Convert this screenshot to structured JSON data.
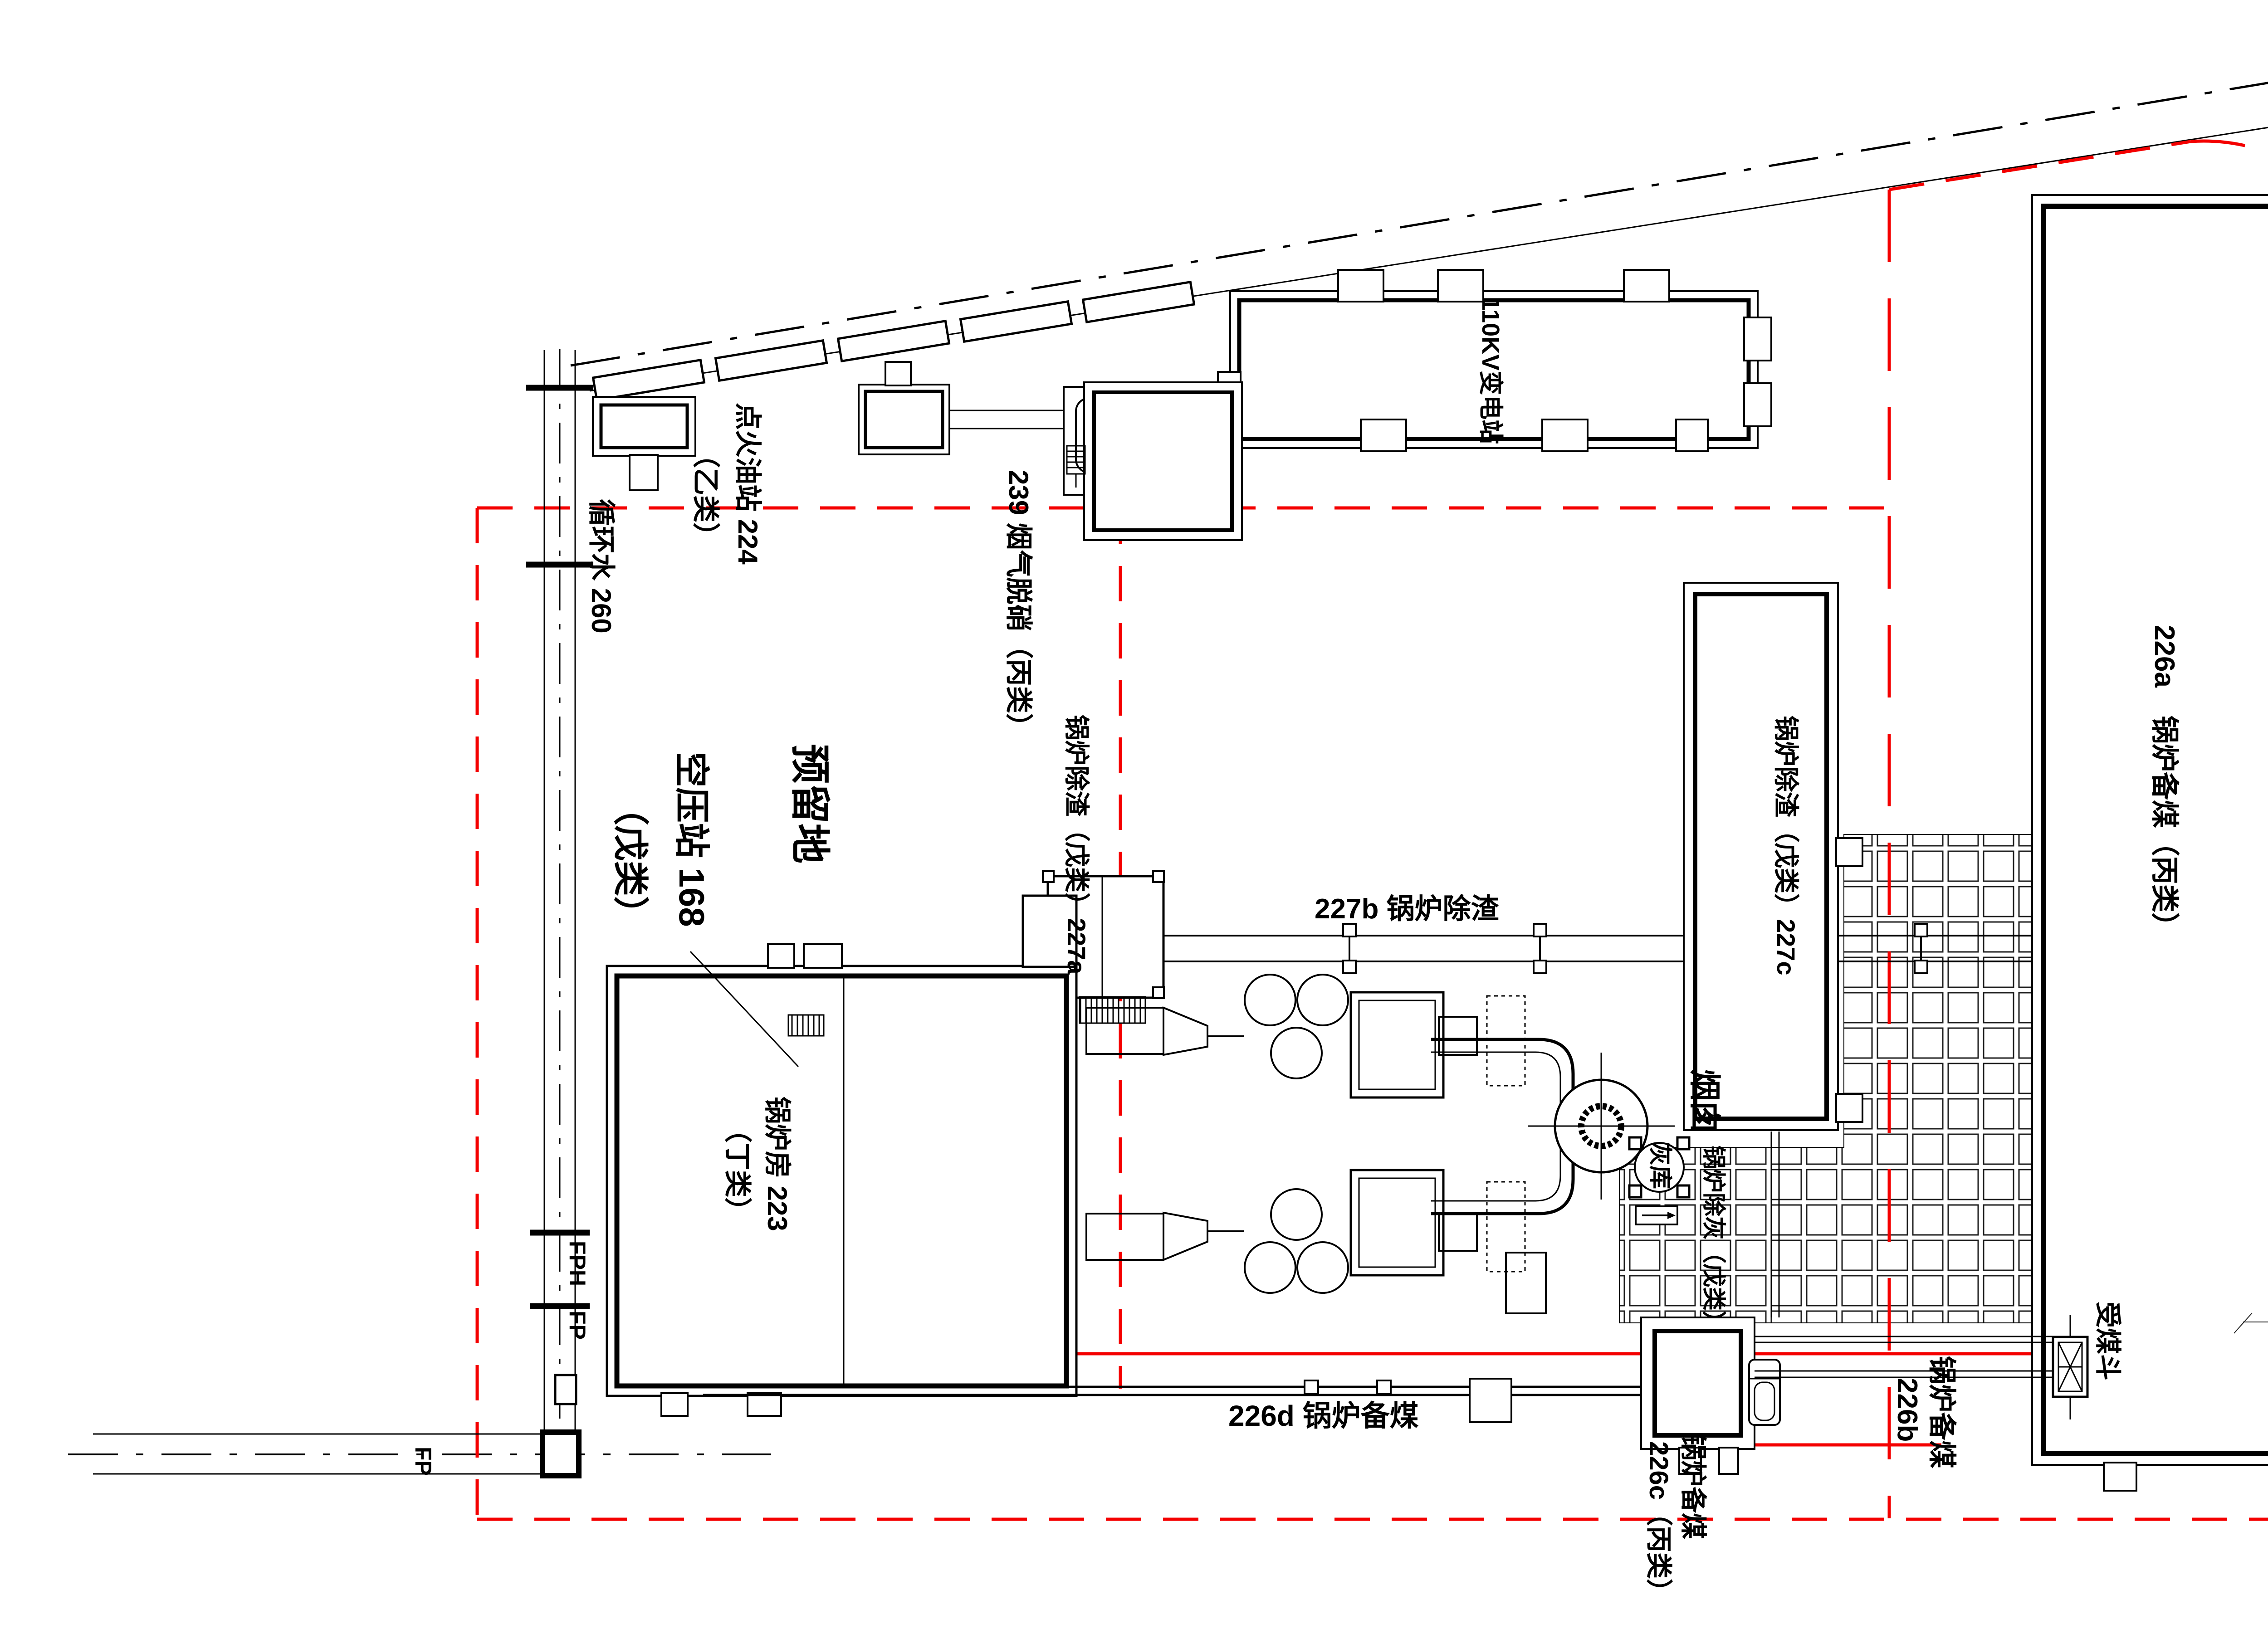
{
  "labels": {
    "substation": "110KV变电站",
    "coal_226a": "226a　锅炉备煤（丙类）",
    "reserved": "预留地",
    "air_station_l1": "空压站 168",
    "air_station_l2": "（戊类）",
    "circ_water": "循环水 260",
    "oil_station_l1": "点火油站 224",
    "oil_station_l2": "（乙类）",
    "denitration": "239 烟气脱硝（丙类）",
    "slag_227a": "锅炉除渣（戊类）227a",
    "slag_227b": "227b 锅炉除渣",
    "slag_227c": "锅炉除渣（戊类）227c",
    "chimney": "烟囱",
    "ash_silo": "灰库",
    "ash_removal": "锅炉除灰（戊类）",
    "coal_226d": "226d 锅炉备煤",
    "coal_226c_l1": "锅炉备煤",
    "coal_226c_l2": "226c（丙类）",
    "coal_226b_l1": "锅炉备煤",
    "coal_226b_l2": "226b",
    "coal_hopper": "受煤斗",
    "boiler_house_l1": "锅炉房 223",
    "boiler_house_l2": "（丁类）",
    "marker_fph": "FPH",
    "marker_fp_mid": "FP",
    "marker_fp_bottom": "FP"
  },
  "dimensions": {
    "road_width_upper": "24.7",
    "road_width_lower": "25.4"
  },
  "logo": {
    "acronym": "CNCEC",
    "company": "赛鼎公司"
  },
  "colors": {
    "boundary_red": "#f40000",
    "line_black": "#000000",
    "logo_blue": "#1c3c8c",
    "logo_yellow": "#eec21c"
  }
}
